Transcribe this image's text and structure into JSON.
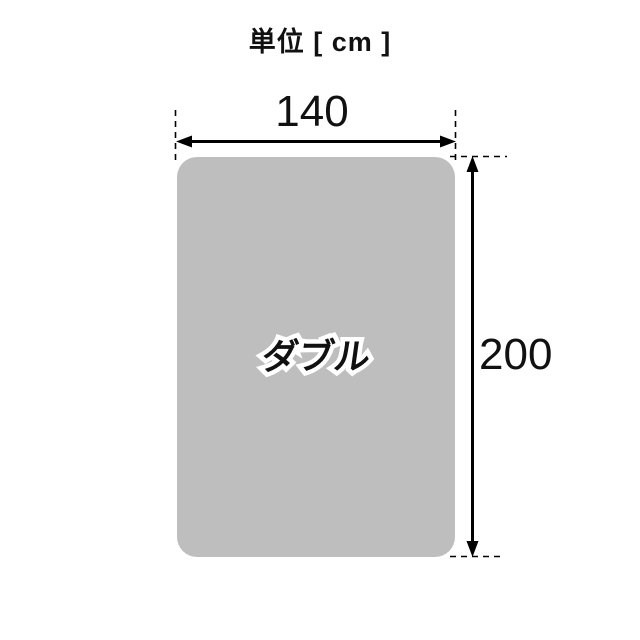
{
  "title": "単位 [ cm ]",
  "diagram": {
    "size_label": "ダブル",
    "width_cm": "140",
    "height_cm": "200"
  },
  "colors": {
    "background": "#ffffff",
    "rect_fill": "#bebebe",
    "line": "#000000",
    "text": "#111111",
    "size_label_outline": "#ffffff"
  }
}
